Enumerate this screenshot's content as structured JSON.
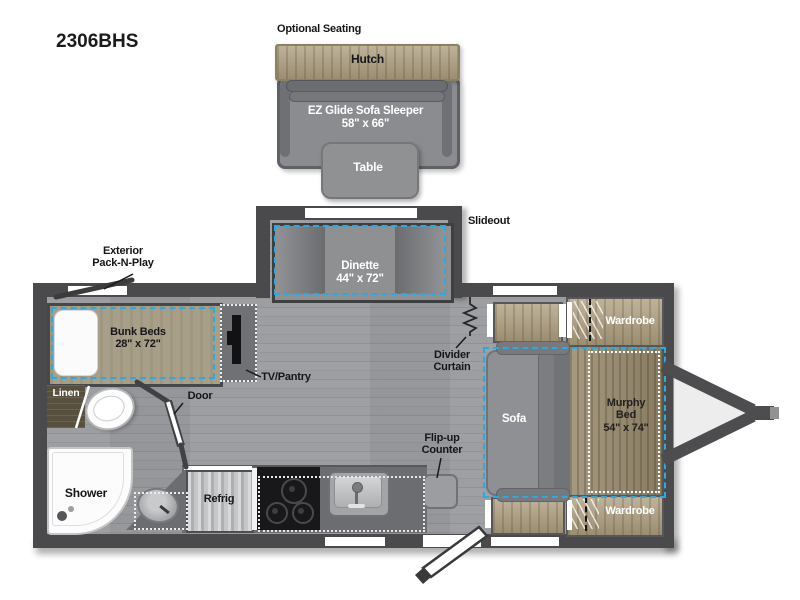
{
  "model": "2306BHS",
  "colors": {
    "wall": "#4a4a4d",
    "floor": "#c7c8ca",
    "accent_blue": "#2ba9e0",
    "wood_light": "#ac9d7e",
    "wood_murphy": "#97896d",
    "wood_dark": "#57503f",
    "sofa_gray": "#8e9093"
  },
  "optional_seating": {
    "label": "Optional Seating",
    "hutch": "Hutch",
    "sofa_sleeper": "EZ Glide Sofa Sleeper",
    "sofa_sleeper_size": "58\" x 66\"",
    "table": "Table"
  },
  "slideout": {
    "label": "Slideout",
    "dinette": "Dinette",
    "dinette_size": "44\" x 72\""
  },
  "bunk_area": {
    "exterior_line1": "Exterior",
    "exterior_line2": "Pack-N-Play",
    "bunk_beds": "Bunk Beds",
    "bunk_size": "28\" x 72\"",
    "tv_pantry": "TV/Pantry"
  },
  "bathroom": {
    "door": "Door",
    "linen": "Linen",
    "shower": "Shower"
  },
  "kitchen": {
    "refrig": "Refrig",
    "flip_up_line1": "Flip-up",
    "flip_up_line2": "Counter"
  },
  "living": {
    "divider_line1": "Divider",
    "divider_line2": "Curtain",
    "sofa": "Sofa",
    "murphy_line1": "Murphy",
    "murphy_line2": "Bed",
    "murphy_size": "54\" x 74\"",
    "wardrobe_top": "Wardrobe",
    "wardrobe_bottom": "Wardrobe"
  }
}
